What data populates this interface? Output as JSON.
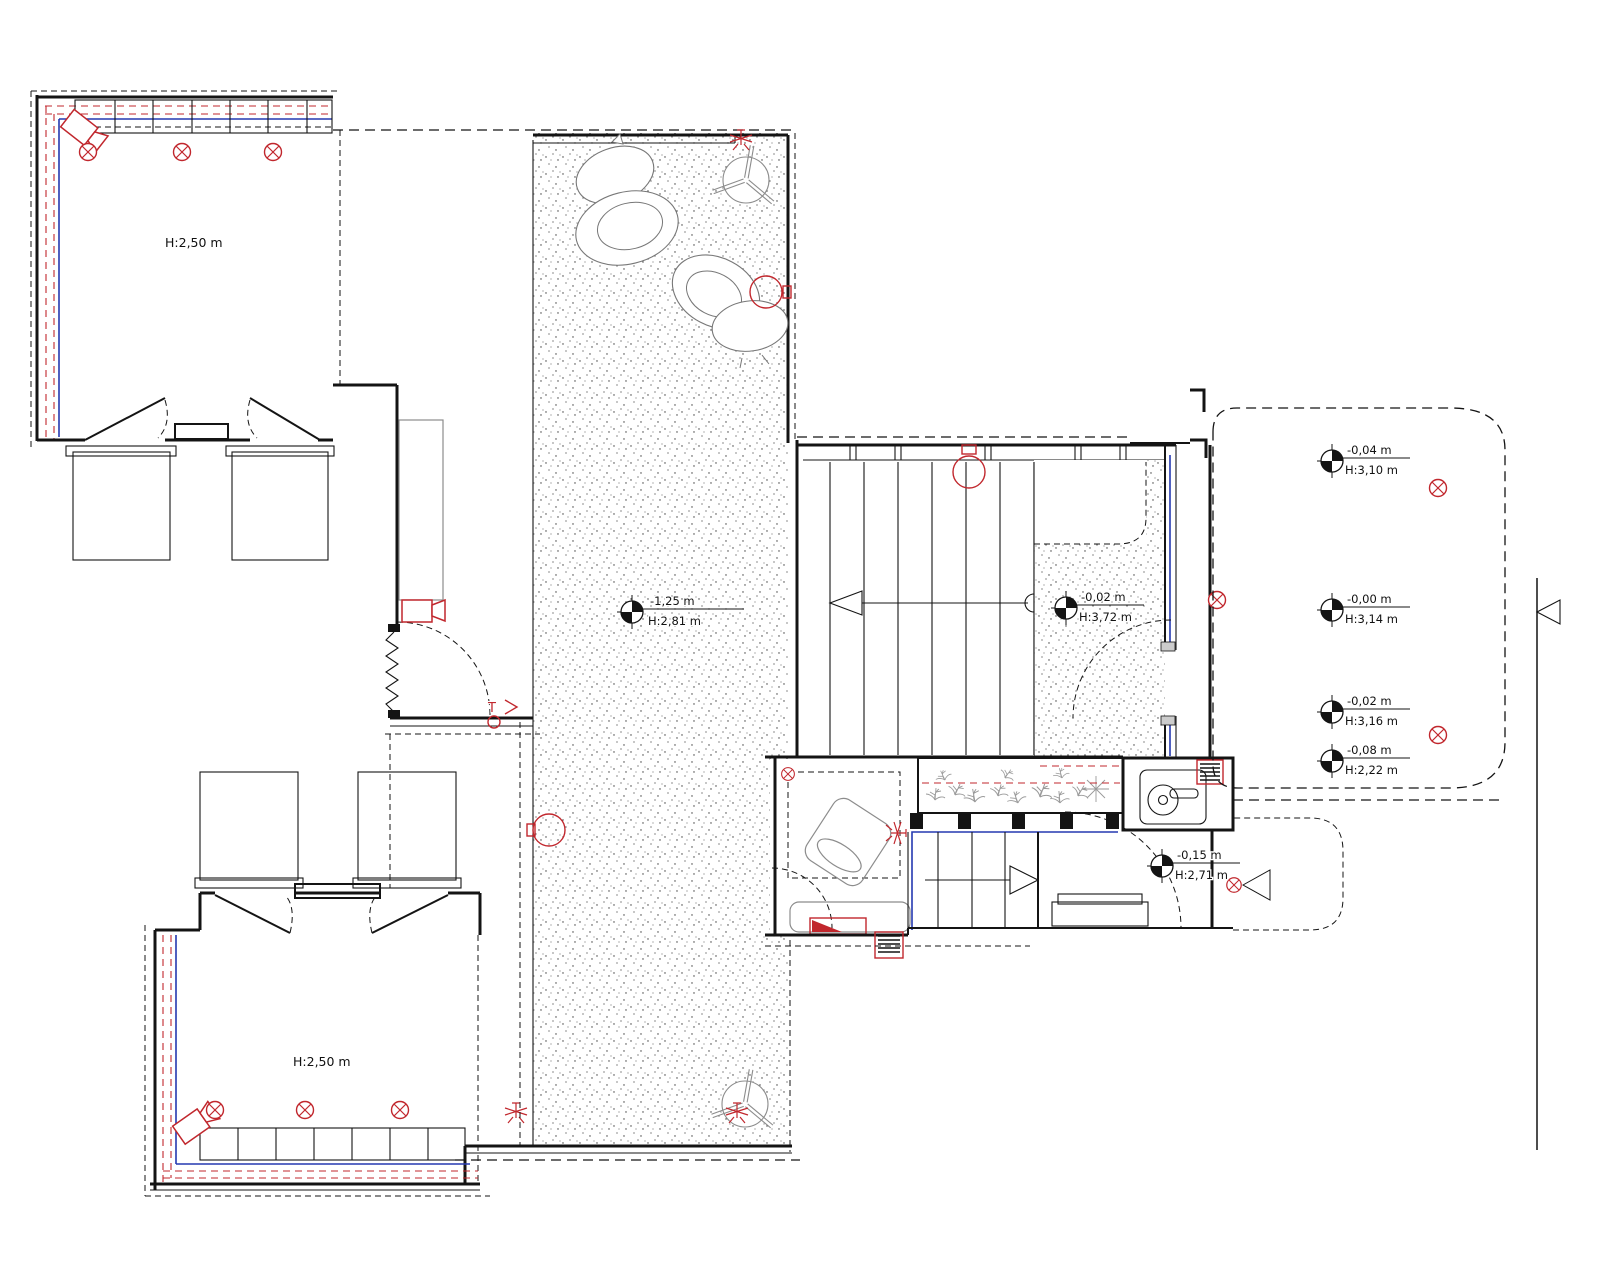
{
  "rooms": [
    {
      "id": "room-top-left",
      "label": "H:2,50 m"
    },
    {
      "id": "room-bottom-left",
      "label": "H:2,50 m"
    }
  ],
  "elevation_markers": [
    {
      "area": "sunken-terrace",
      "level": "-1,25 m",
      "height": "H:2,81 m"
    },
    {
      "area": "stair-hall",
      "level": "-0,02 m",
      "height": "H:3,72 m"
    },
    {
      "area": "right-terrace-top",
      "level": "-0,04 m",
      "height": "H:3,10 m"
    },
    {
      "area": "right-terrace-middle",
      "level": "-0,00 m",
      "height": "H:3,14 m"
    },
    {
      "area": "right-terrace-lower",
      "level": "-0,02 m",
      "height": "H:3,16 m"
    },
    {
      "area": "right-terrace-bottom",
      "level": "-0,08 m",
      "height": "H:2,22 m"
    },
    {
      "area": "entrance",
      "level": "-0,15 m",
      "height": "H:2,71 m"
    }
  ],
  "annotations": {
    "door_tag": "T"
  },
  "symbols": {
    "ceiling_light": "red circled X",
    "security_camera": "red camera body with lens",
    "sprinkler": "red radiating star",
    "level_marker": "black-white quadrant circle",
    "stair_direction": "open triangle arrow",
    "section_marker": "triangle on section line"
  },
  "colors": {
    "line": "#141414",
    "red": "#c1272d",
    "blue": "#2539b0",
    "gray": "#8c8c8c",
    "background": "#ffffff"
  }
}
